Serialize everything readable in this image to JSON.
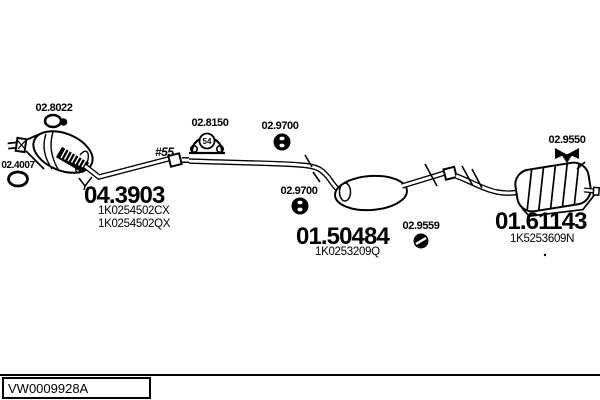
{
  "parts": {
    "clamp": {
      "code": "02.8022"
    },
    "flange_gasket": {
      "code": "02.4007"
    },
    "mounting_kit": {
      "code": "02.8150",
      "badge": "54"
    },
    "rubber_hanger_front": {
      "code": "02.9700"
    },
    "rubber_hanger_mid": {
      "code": "02.9700"
    },
    "rubber_hanger_round": {
      "code": "02.9559"
    },
    "rubber_hanger_rear": {
      "code": "02.9550"
    },
    "front_pipe_cat": {
      "code": "04.3903",
      "refs": [
        "1K0254502CX",
        "1K0254502QX"
      ],
      "pipe_note": "#55"
    },
    "centre_silencer": {
      "code": "01.50484",
      "refs": [
        "1K0253209Q"
      ]
    },
    "rear_silencer": {
      "code": "01.61143",
      "refs": [
        "1K5253609N"
      ]
    }
  },
  "footer": {
    "drawing_code": "VW0009928A"
  },
  "colors": {
    "line": "#000000",
    "background": "#ffffff"
  }
}
